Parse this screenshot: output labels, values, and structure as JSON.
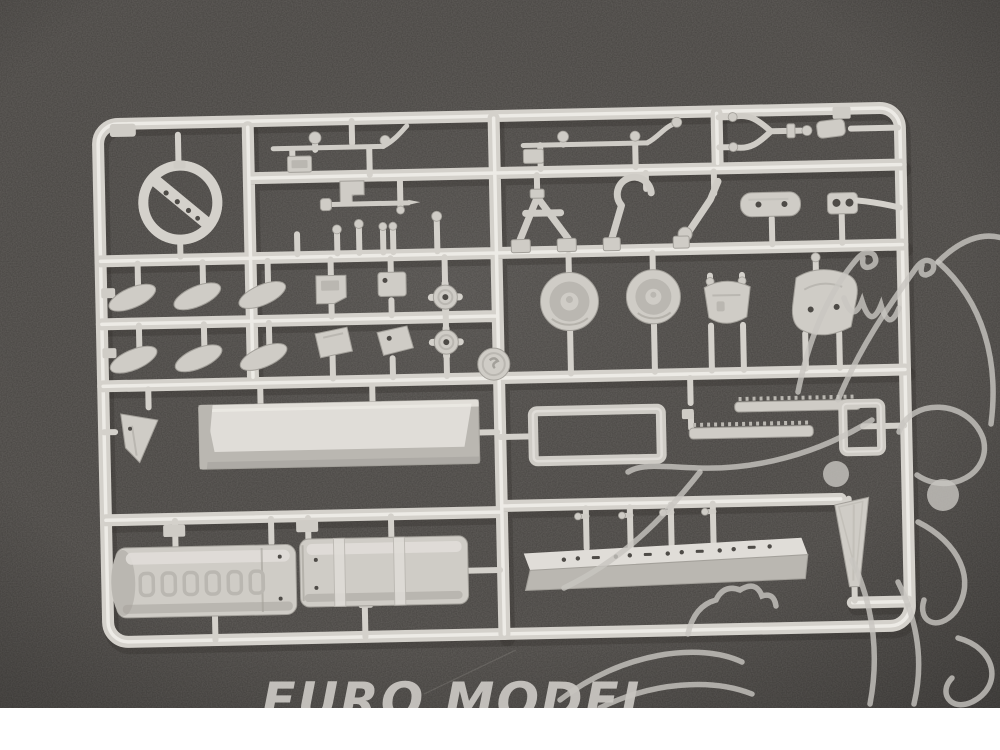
{
  "photo": {
    "subject": "Unassembled plastic model kit sprue with molded parts photographed on a dark gray textured surface"
  },
  "watermark": {
    "text": "EURO MODEL"
  },
  "colors": {
    "background": "#474441",
    "plastic": "#d4d1cb",
    "plastic_highlight": "#edebe6",
    "plastic_shadow": "#a3a09a",
    "part_fill": "#cfccc6",
    "part_light": "#e0ddd8",
    "part_dark": "#bab7b1",
    "hole": "#4e4b47",
    "shadow": "#2e2c29",
    "watermark": "#c8c5c0",
    "bottom_strip": "#ffffff"
  }
}
